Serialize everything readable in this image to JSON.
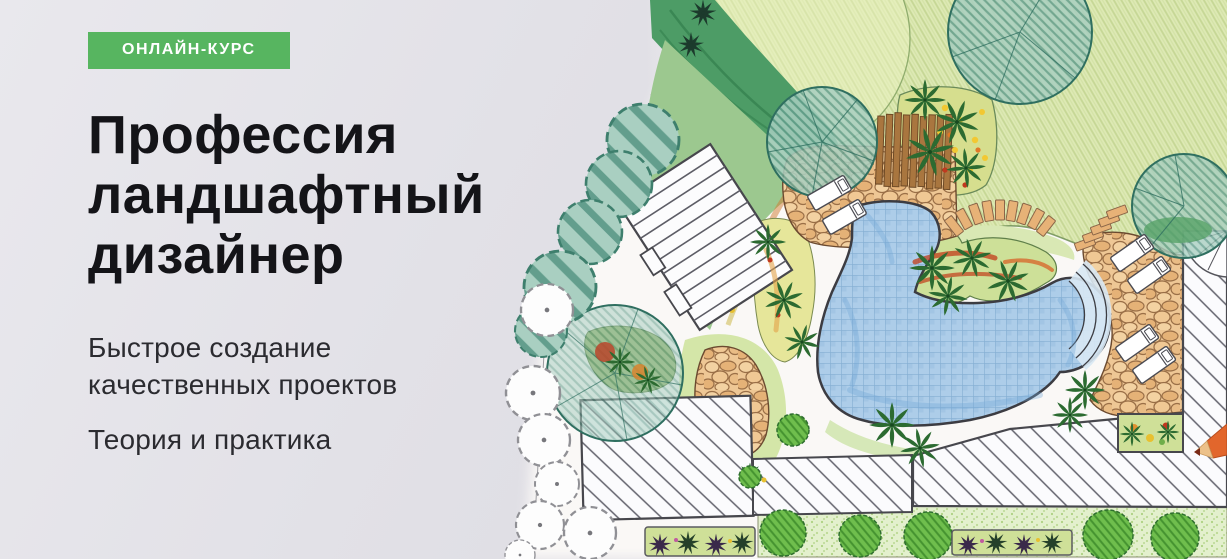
{
  "hero": {
    "badge": {
      "label": "ОНЛАЙН-КУРС",
      "background": "#57b560",
      "text_color": "#ffffff"
    },
    "title": {
      "full": "Профессия ландшафтный дизайнер",
      "line1": "Профессия",
      "line2": "ландшафтный",
      "line3": "дизайнер",
      "color": "#141418"
    },
    "subtitles": [
      "Быстрое создание качественных проектов",
      "Теория и практика"
    ]
  },
  "illustration": {
    "name": "landscape-plan-drawing",
    "description": "Hand-drawn colored master plan of a garden plot: lawn, teal trees, shrub row, hatched building roofs, kidney-shaped swimming pool with steps, flagstone patios, wooden pergola, sun loungers, flower beds, box hedges and a colored pencil lying on the paper",
    "elements": [
      "lawn",
      "hedge-border",
      "teal-trees",
      "shrub-row",
      "outline-trees",
      "main-house-roof",
      "guest-house-roof",
      "terrace-deck",
      "corner-building-roof",
      "spiral-stair",
      "swimming-pool",
      "pool-steps",
      "stone-patio",
      "flagstone-path",
      "stepping-stones",
      "wooden-pergola",
      "sun-loungers",
      "flower-beds",
      "palm-plants",
      "box-bushes",
      "flower-boxes",
      "colored-pencil"
    ],
    "colors": {
      "paper": "#faf8f6",
      "lawn_green": "#dde9b4",
      "tree_teal": "#a9cfc1",
      "hedge_green": "#4d9c66",
      "pool_blue": "#adcde9",
      "stone_tan": "#eec795",
      "bush_green": "#6fbe4d",
      "wood_brown": "#a9763f",
      "pencil_orange": "#e2662c"
    }
  },
  "page": {
    "background_left": "#e3e2e8",
    "background_right": "#f8f7f7"
  }
}
